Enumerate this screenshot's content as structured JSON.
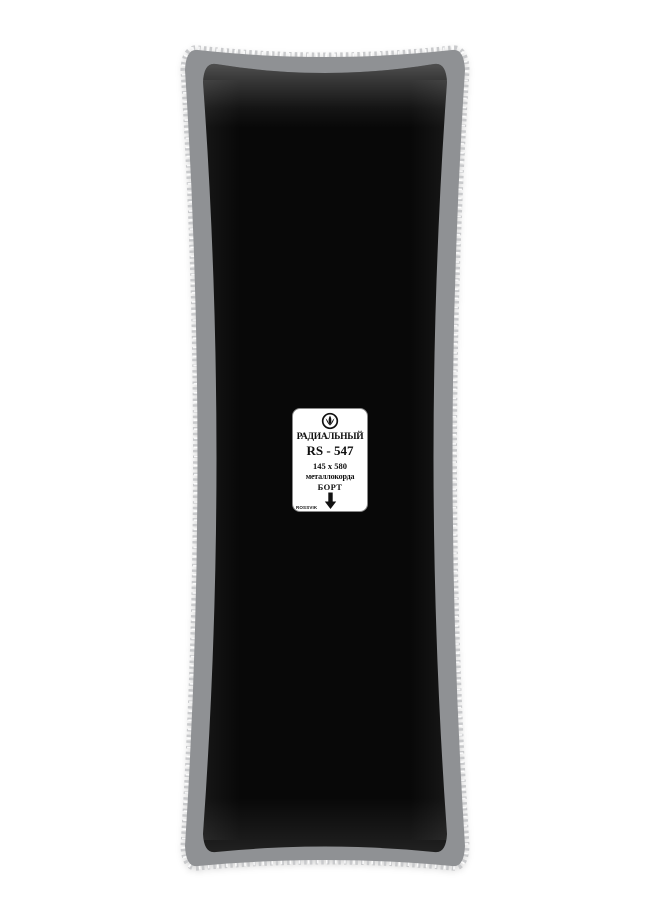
{
  "label": {
    "type": "РАДИАЛЬНЫЙ",
    "model": "RS - 547",
    "size": "145 x 580",
    "cord": "металлокорда",
    "bead": "БОРТ",
    "brand": "ROSSVIK",
    "logo_icon": "rossvik-emblem-icon",
    "direction_icon": "down-arrow-icon"
  },
  "colors": {
    "background": "#ffffff",
    "rubber_black": "#080808",
    "border_gray": "#8f9194",
    "serration_gray": "#c9cacc",
    "label_background": "#ffffff",
    "label_text": "#101010"
  }
}
